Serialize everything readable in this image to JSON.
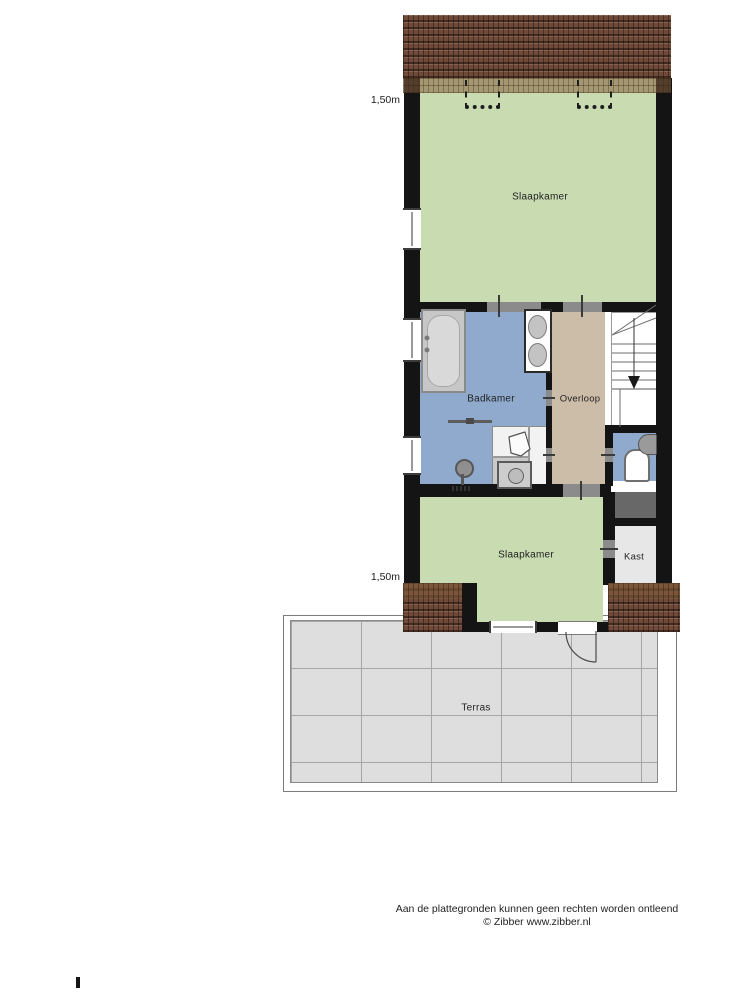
{
  "palette": {
    "room_green": "#c8dbb1",
    "room_blue": "#90aacd",
    "room_tan": "#ccbda8",
    "roof_brown": "#6f4a39",
    "wall_black": "#141414",
    "terrace_tile": "#dedede",
    "kast_gray": "#e7e7e7",
    "void_gray": "#686868"
  },
  "rooms": {
    "slaapkamer_top": {
      "label": "Slaapkamer"
    },
    "badkamer": {
      "label": "Badkamer"
    },
    "overloop": {
      "label": "Overloop"
    },
    "slaapkamer_bottom": {
      "label": "Slaapkamer"
    },
    "kast": {
      "label": "Kast"
    },
    "terras": {
      "label": "Terras"
    }
  },
  "dimensions": {
    "top": "1,50m",
    "bottom": "1,50m"
  },
  "footer": {
    "line1": "Aan de plattegronden kunnen geen rechten worden ontleend",
    "line2": "© Zibber www.zibber.nl"
  },
  "fixtures": [
    "bathtub",
    "double-washbasin",
    "shower",
    "glass-screen",
    "washing-machine",
    "boiler",
    "toilet",
    "corner-sink",
    "staircase-down",
    "roof-window",
    "roof-window",
    "door-swing"
  ]
}
